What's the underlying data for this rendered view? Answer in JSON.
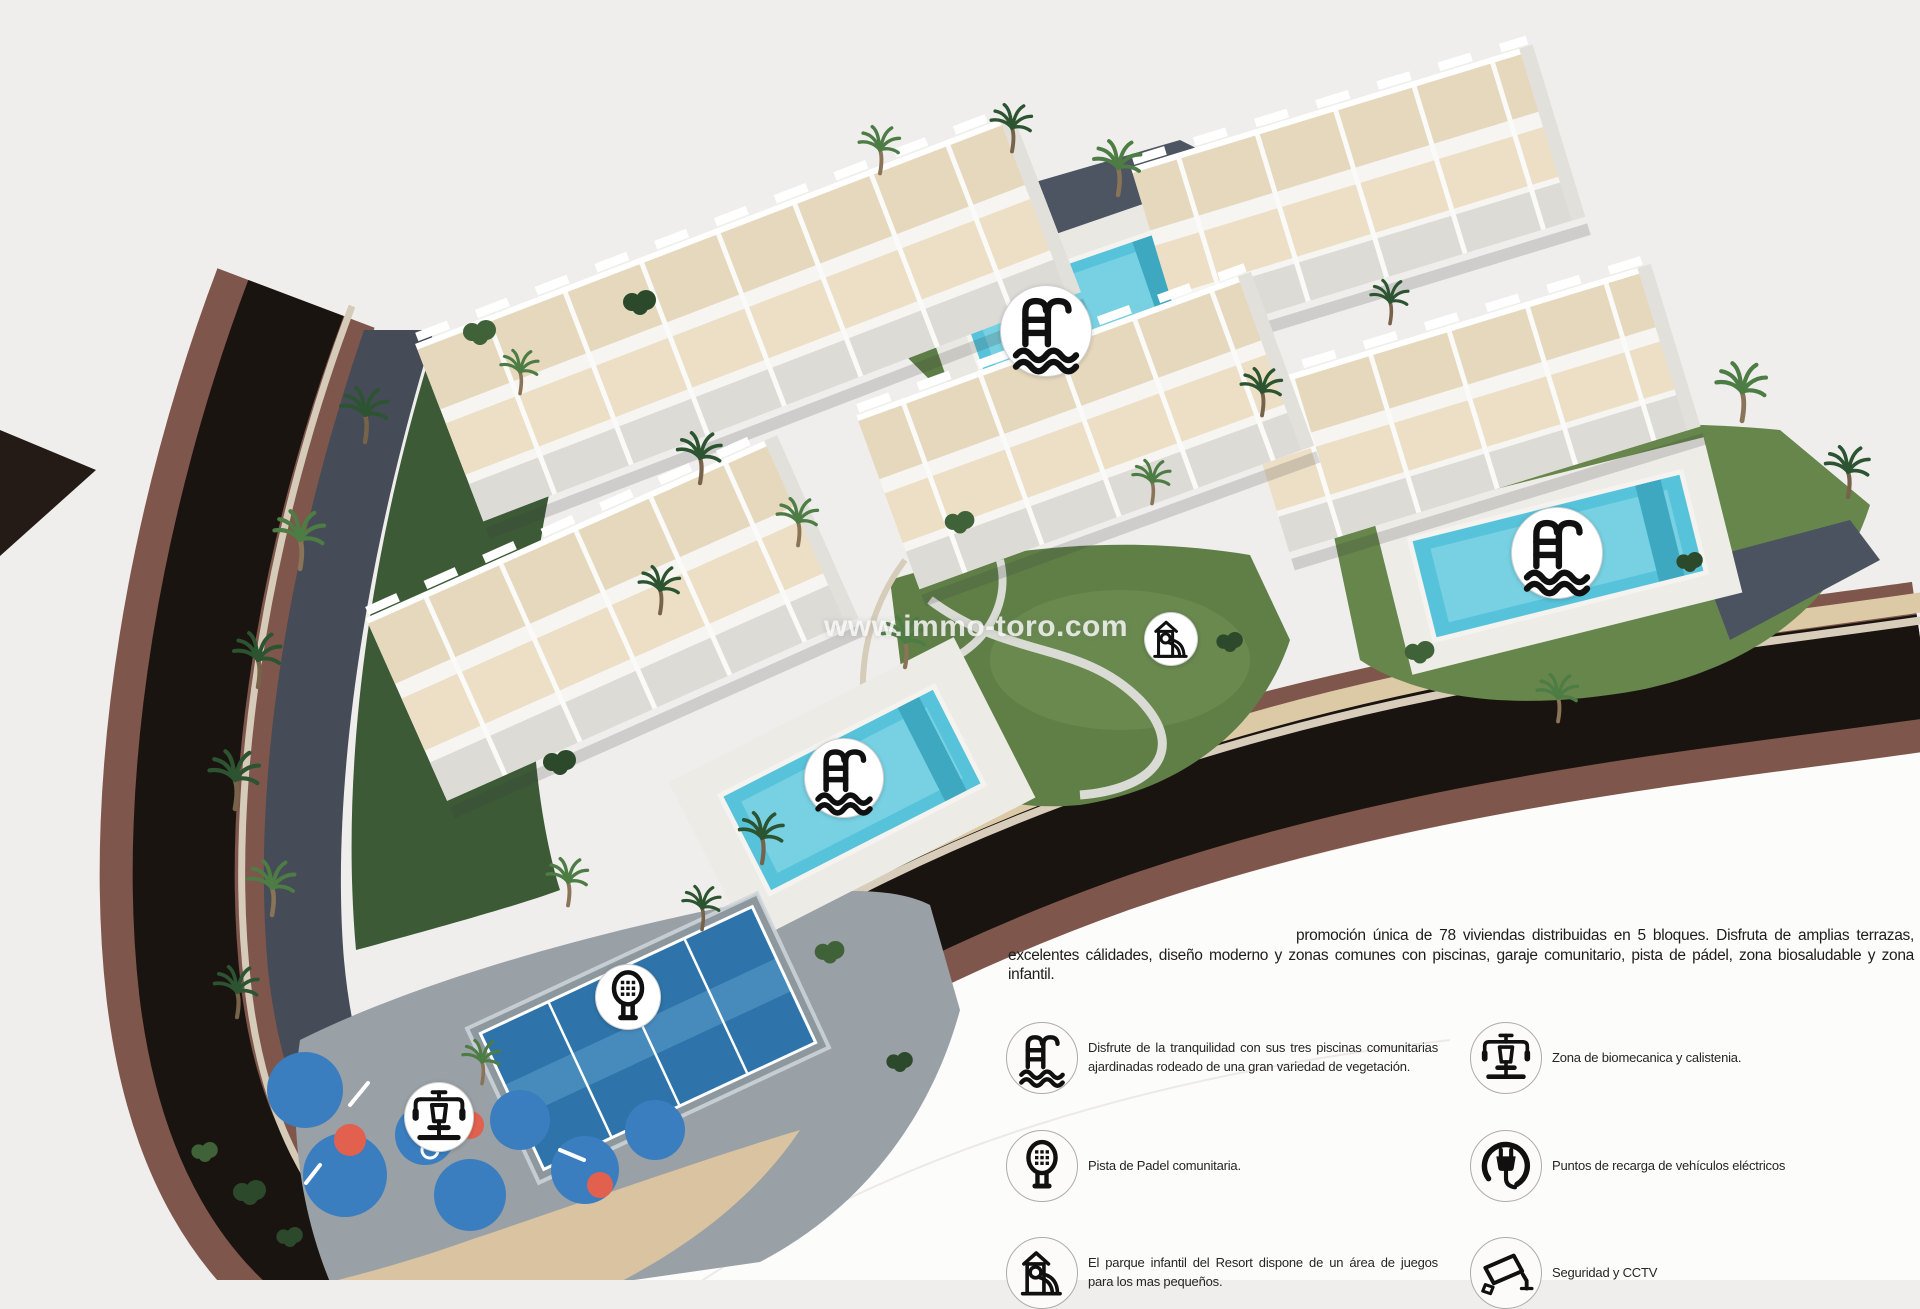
{
  "watermark": {
    "text": "www.immo-toro.com"
  },
  "description": {
    "text": "promoción única de 78 viviendas distribuidas en 5 bloques. Disfruta de amplias terrazas, excelentes cálidades, diseño moderno y zonas comunes con piscinas, garaje comunitario, pista de pádel, zona biosaludable y zona infantil."
  },
  "legend": {
    "left": [
      {
        "icon": "pool-icon",
        "text": "Disfrute de la tranquilidad con sus tres piscinas comunitarias ajardinadas rodeado de una gran variedad de vegetación."
      },
      {
        "icon": "padel-icon",
        "text": "Pista de Padel comunitaria."
      },
      {
        "icon": "playground-icon",
        "text": "El parque infantil del Resort dispone de un área de juegos para los mas pequeños."
      }
    ],
    "right": [
      {
        "icon": "biomechanics-icon",
        "text": "Zona de biomecanica y calistenia."
      },
      {
        "icon": "ev-charger-icon",
        "text": "Puntos de recarga de vehículos eléctricos"
      },
      {
        "icon": "cctv-icon",
        "text": "Seguridad y CCTV"
      }
    ]
  },
  "map_markers": [
    {
      "id": "pool-north",
      "icon": "pool-icon"
    },
    {
      "id": "pool-east",
      "icon": "pool-icon"
    },
    {
      "id": "pool-west",
      "icon": "pool-icon"
    },
    {
      "id": "playground",
      "icon": "playground-icon"
    },
    {
      "id": "padel",
      "icon": "padel-icon"
    },
    {
      "id": "biomechanics",
      "icon": "biomechanics-icon"
    }
  ],
  "colors": {
    "background": "#efeeec",
    "foreground_white": "#fcfcfb",
    "road": "#1a1410",
    "brick_wall": "#7f564b",
    "pool_water": "#56c3da",
    "padel_court": "#2e74aa",
    "lawn": "#5f7f47",
    "icon_ink": "#101010"
  }
}
